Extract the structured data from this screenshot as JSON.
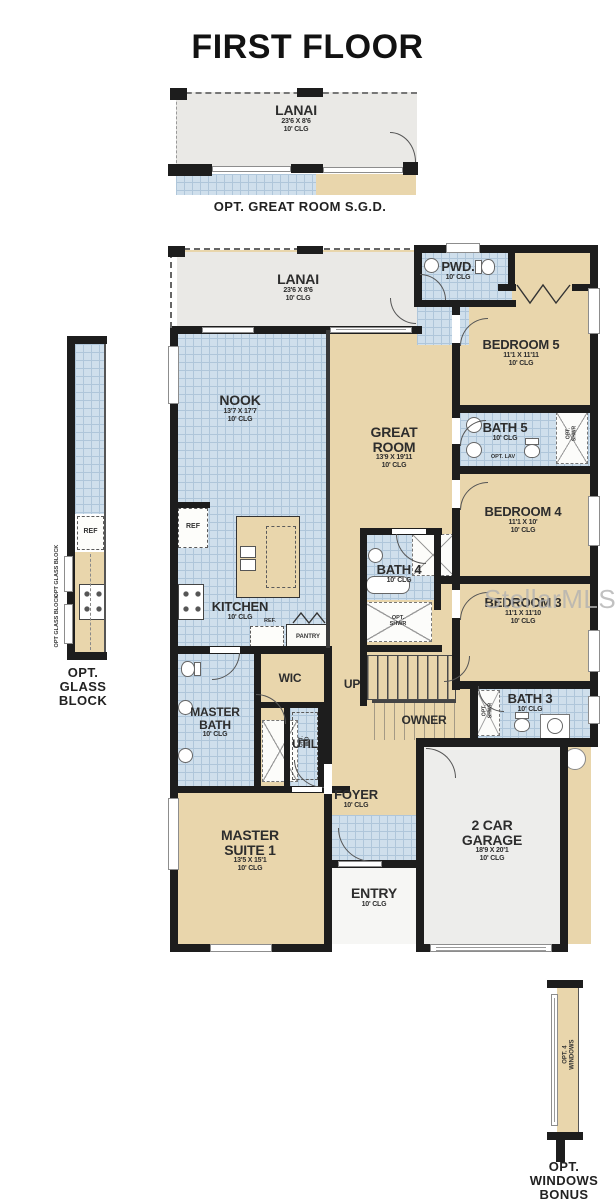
{
  "title": "FIRST FLOOR",
  "watermark": "StellarMLS",
  "colors": {
    "tan": "#e9d6ac",
    "tile": "#cfdfec",
    "gray": "#eae9e6",
    "garage": "#ededeb",
    "wall": "#1d1d1d"
  },
  "top_inset": {
    "lanai": {
      "name": "LANAI",
      "dims": "23'6 X 8'6",
      "clg": "10' CLG"
    },
    "caption": "OPT. GREAT ROOM S.G.D."
  },
  "left_inset": {
    "ref": "REF",
    "glass_label_1": "OPT GLASS BLOCK",
    "glass_label_2": "OPT GLASS BLOCK",
    "caption": "OPT.\nGLASS\nBLOCK"
  },
  "bottom_inset": {
    "window_label": "OPT. 4\nWINDOWS",
    "caption": "OPT.\nWINDOWS\nBONUS"
  },
  "rooms": {
    "lanai": {
      "name": "LANAI",
      "dims": "23'6 X 8'6",
      "clg": "10' CLG"
    },
    "pwd": {
      "name": "PWD.",
      "clg": "10' CLG"
    },
    "bedroom5": {
      "name": "BEDROOM 5",
      "dims": "11'1 X 11'11",
      "clg": "10' CLG"
    },
    "nook": {
      "name": "NOOK",
      "dims": "13'7 X 17'7",
      "clg": "10' CLG"
    },
    "great_room": {
      "name": "GREAT\nROOM",
      "dims": "13'9 X 19'11",
      "clg": "10' CLG"
    },
    "bath5": {
      "name": "BATH 5",
      "clg": "10' CLG",
      "opt_lav": "OPT. LAV",
      "opt_shwr": "OPT.\nSHWR"
    },
    "bedroom4": {
      "name": "BEDROOM 4",
      "dims": "11'1 X 10'",
      "clg": "10' CLG"
    },
    "bath4": {
      "name": "BATH 4",
      "clg": "10' CLG",
      "opt_shwr": "OPT.\nSHWR"
    },
    "bedroom3": {
      "name": "BEDROOM 3",
      "dims": "11'1 X 11'10",
      "clg": "10' CLG"
    },
    "kitchen": {
      "name": "KITCHEN",
      "clg": "10' CLG",
      "ref": "REF",
      "ref_small": "REF.",
      "pantry": "PANTRY"
    },
    "wic": {
      "name": "WIC"
    },
    "master_bath": {
      "name": "MASTER\nBATH",
      "clg": "10' CLG"
    },
    "util": {
      "name": "UTIL",
      "opt_wd": "OPT.\nW/D"
    },
    "up": {
      "name": "UP"
    },
    "owner": {
      "name": "OWNER"
    },
    "bath3": {
      "name": "BATH 3",
      "clg": "10' CLG",
      "opt_shwr": "OPT.\nSHWR"
    },
    "foyer": {
      "name": "FOYER",
      "clg": "10' CLG"
    },
    "master_suite": {
      "name": "MASTER\nSUITE 1",
      "dims": "13'5 X 15'1",
      "clg": "10' CLG"
    },
    "entry": {
      "name": "ENTRY",
      "clg": "10' CLG"
    },
    "garage": {
      "name": "2 CAR\nGARAGE",
      "dims": "18'9 X 20'1",
      "clg": "10' CLG"
    }
  }
}
